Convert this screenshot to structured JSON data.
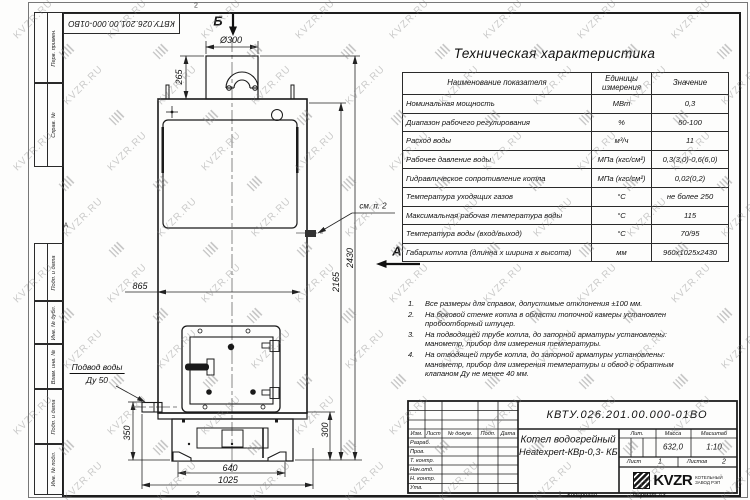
{
  "doc_number": "КВТУ.026.201.00.000-01ВО",
  "watermark": {
    "text": "KVZR.RU"
  },
  "frame": {
    "left_boxes_top": [
      "Перв. примен.",
      "Справ. №"
    ],
    "left_boxes_bottom": [
      "Подп. и дата",
      "Инв. № дубл.",
      "Взам. инв. №",
      "Подп. и дата",
      "Инв. № подл."
    ]
  },
  "drawing": {
    "labels": [
      {
        "text": "Б",
        "x": 218,
        "y": 21,
        "cls": "view-letter"
      },
      {
        "text": "Ø300",
        "x": 231,
        "y": 40,
        "cls": ""
      },
      {
        "text": "265",
        "x": 179,
        "y": 77,
        "cls": "r90"
      },
      {
        "text": "865",
        "x": 140,
        "y": 286,
        "cls": ""
      },
      {
        "text": "2165",
        "x": 336,
        "y": 282,
        "cls": "r90"
      },
      {
        "text": "2430",
        "x": 350,
        "y": 258,
        "cls": "r90"
      },
      {
        "text": "300",
        "x": 325,
        "y": 430,
        "cls": "r90"
      },
      {
        "text": "350",
        "x": 127,
        "y": 433,
        "cls": "r90"
      },
      {
        "text": "640",
        "x": 230,
        "y": 468,
        "cls": ""
      },
      {
        "text": "1025",
        "x": 228,
        "y": 480,
        "cls": ""
      },
      {
        "text": "А",
        "x": 397,
        "y": 251,
        "cls": "view-letter"
      },
      {
        "text": "см. п. 2",
        "x": 373,
        "y": 206,
        "cls": "note-ref"
      },
      {
        "text": "Подвод воды",
        "x": 97,
        "y": 368,
        "cls": "callout u"
      },
      {
        "text": "Ду 50",
        "x": 97,
        "y": 380,
        "cls": "callout"
      },
      {
        "text": "2",
        "x": 196,
        "y": 6,
        "cls": "zone"
      },
      {
        "text": "А",
        "x": 66,
        "y": 226,
        "cls": "zone"
      },
      {
        "text": "2",
        "x": 198,
        "y": 495,
        "cls": "zone"
      },
      {
        "text": "1",
        "x": 560,
        "y": 495,
        "cls": "zone"
      }
    ]
  },
  "tech_table": {
    "title": "Техническая характеристика",
    "headers": [
      "Наименование показателя",
      "Единицы измерения",
      "Значение"
    ],
    "rows": [
      [
        "Номинальная мощность",
        "МВт",
        "0,3"
      ],
      [
        "Диапазон рабочего регулирования",
        "%",
        "50-100"
      ],
      [
        "Расход воды",
        "м³/ч",
        "11"
      ],
      [
        "Рабочее давление воды",
        "МПа (кгс/см²)",
        "0,3(3,0)-0,6(6,0)"
      ],
      [
        "Гидравлическое сопротивление котла",
        "МПа (кгс/см²)",
        "0,02(0,2)"
      ],
      [
        "Температура уходящих газов",
        "°С",
        "не более 250"
      ],
      [
        "Максимальная рабочая температура воды",
        "°С",
        "115"
      ],
      [
        "Температура воды (вход/выход)",
        "°С",
        "70/95"
      ],
      [
        "Габариты котла (длинна х ширина х высота)",
        "мм",
        "960х1025х2430"
      ]
    ]
  },
  "notes": [
    "Все размеры для справок, допустимые отклонения ±100 мм.",
    "На боковой стенке котла в области топочной камеры установлен пробоотборный штуцер.",
    "На подводящей трубе котла, до запорной арматуры установлены: манометр, прибор для измерения температуры.",
    "На отводящей трубе котла, до запорной арматуры установлены: манометр, прибор для измерения температуры и обвод с обратным клапаном Ду не менее 40 мм."
  ],
  "title_block": {
    "product_name_line1": "Котел водогрейный",
    "product_name_line2": "Heatexpert-КВр-0,3- КБ(К",
    "header_cells": [
      "Изм.",
      "Лист",
      "№ докум.",
      "Подп.",
      "Дата"
    ],
    "sign_rows": [
      "Разраб.",
      "Пров.",
      "Т. контр.",
      "Нач.отд.",
      "Н. контр.",
      "Утв."
    ],
    "lit_label": "Лит.",
    "mass_label": "Масса",
    "scale_label": "Масштаб",
    "mass_value": "632,0",
    "scale_value": "1:10",
    "sheet_label": "Лист",
    "sheet_value": "1",
    "sheets_label": "Листов",
    "sheets_value": "2",
    "logo_text": "KVZR",
    "logo_sub1": "КОТЕЛЬНЫЙ",
    "logo_sub2": "ЗАВОД РЭП",
    "copied_label": "Копировал",
    "format_label": "Формат А3"
  }
}
